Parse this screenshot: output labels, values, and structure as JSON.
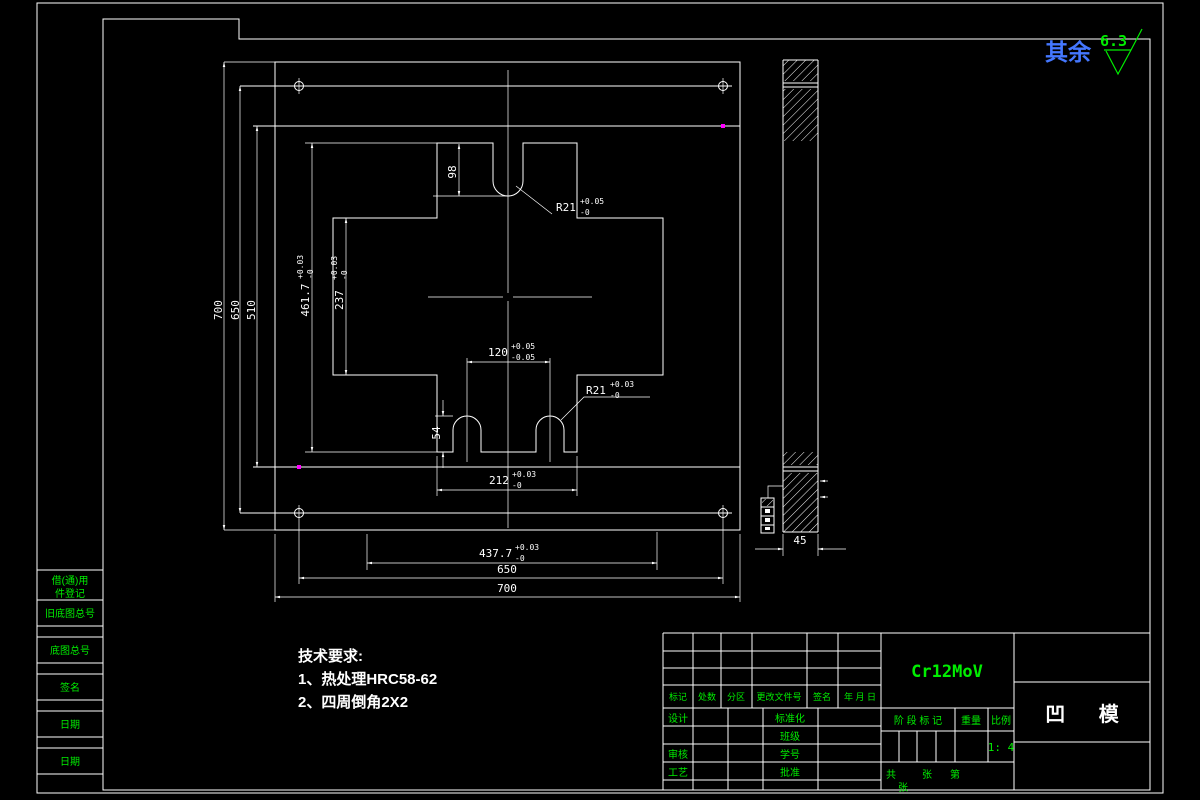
{
  "surface_note": {
    "label": "其余",
    "roughness": "6.3"
  },
  "tech": {
    "title": "技术要求:",
    "line1": "1、热处理HRC58-62",
    "line2": "2、四周倒角2X2"
  },
  "dims": {
    "l700": "700",
    "l650": "650",
    "l510": "510",
    "h4617": {
      "v": "461.7",
      "u": "+0.03",
      "d": "-0"
    },
    "h237": {
      "v": "237",
      "u": "+0.03",
      "d": "-0"
    },
    "d98": "98",
    "r21t": {
      "v": "R21",
      "u": "+0.05",
      "d": "-0"
    },
    "w120": {
      "v": "120",
      "u": "+0.05",
      "d": "-0.05"
    },
    "r21b": {
      "v": "R21",
      "u": "+0.03",
      "d": "-0"
    },
    "d54": "54",
    "w212": {
      "v": "212",
      "u": "+0.03",
      "d": "-0"
    },
    "w4377": {
      "v": "437.7",
      "u": "+0.03",
      "d": "-0"
    },
    "b650": "650",
    "b700": "700",
    "s45": "45"
  },
  "border_blocks": {
    "r1a": "借(通)用",
    "r1b": "件登记",
    "r2": "旧底图总号",
    "r3": "底图总号",
    "r4": "签名",
    "r5": "日期",
    "r6": "日期"
  },
  "title_block": {
    "material": "Cr12MoV",
    "part_name": "凹 模",
    "rev_headers": [
      "标记",
      "处数",
      "分区",
      "更改文件号",
      "签名",
      "年 月 日"
    ],
    "roles": {
      "design": "设计",
      "check": "审核",
      "process": "工艺",
      "standard": "标准化",
      "cls": "班级",
      "sid": "学号",
      "approve": "批准"
    },
    "stage": "阶 段 标 记",
    "weight": "重量",
    "scale_label": "比例",
    "scale_value": "1: 4",
    "sheet": {
      "total": "共",
      "sheet1": "张",
      "no": "第",
      "sheet2": "张"
    }
  }
}
